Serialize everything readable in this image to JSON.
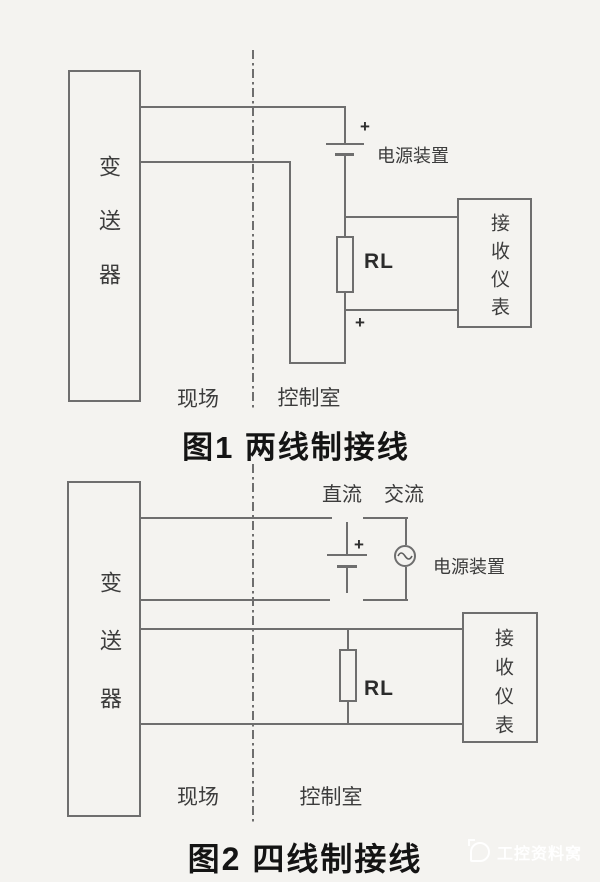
{
  "figure1": {
    "title": "图1 两线制接线",
    "transmitter_label": "变送器",
    "receiver_label": "接收仪表",
    "power_supply_label": "电源装置",
    "load_resistor_label": "RL",
    "polarity_top": "+",
    "polarity_bottom": "+",
    "field_zone_label": "现场",
    "control_room_label": "控制室"
  },
  "figure2": {
    "title": "图2 四线制接线",
    "transmitter_label": "变送器",
    "receiver_label": "接收仪表",
    "dc_label": "直流",
    "ac_label": "交流",
    "power_supply_label": "电源装置",
    "load_resistor_label": "RL",
    "polarity": "+",
    "field_zone_label": "现场",
    "control_room_label": "控制室"
  },
  "watermark": {
    "text": "工控资料窝"
  },
  "colors": {
    "background": "#f4f3f0",
    "line": "#6e6e6e",
    "label_text": "#3c3c3c",
    "title_text": "#141414",
    "watermark": "#ffffff"
  }
}
